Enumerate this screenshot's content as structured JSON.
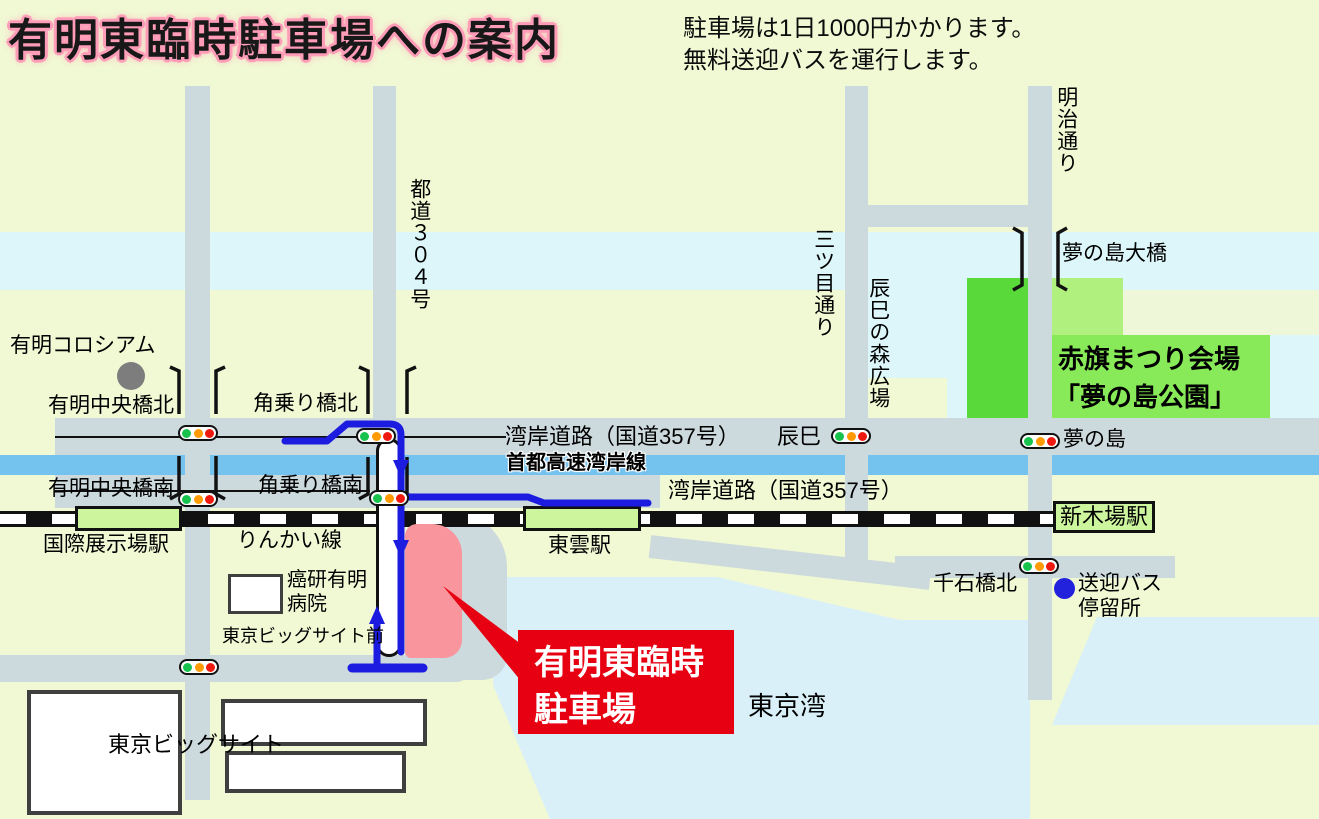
{
  "title": "有明東臨時駐車場への案内",
  "notes": [
    "駐車場は1日1000円かかります。",
    "無料送迎バスを運行します。"
  ],
  "colors": {
    "background": "#f1f8d4",
    "road": "#ccd9dd",
    "canal": "#dcf6fa",
    "bay_water": "#d9f0f8",
    "expressway_blue": "#74c2ee",
    "route_blue": "#1c1ce0",
    "parking_pink": "#f8959d",
    "accent_red": "#e60012",
    "park_green_dark": "#5ada3a",
    "park_green_mid": "#88ea58",
    "park_green_light": "#b0f07e",
    "station_green": "#ccf59e"
  },
  "icons": {
    "traffic_light": "traffic-light",
    "bus_stop_dot": "bus-stop-dot",
    "landmark_dot": "landmark-dot"
  },
  "map": {
    "labels": {
      "ariake_colosseum": "有明コロシアム",
      "ariake_chuo_kita": "有明中央橋北",
      "ariake_chuo_minami": "有明中央橋南",
      "kakunori_kita": "角乗り橋北",
      "kakunori_minami": "角乗り橋南",
      "todo304": "都道３０４号",
      "wangan_route_upper": "湾岸道路（国道357号）",
      "tatsumi": "辰巳",
      "shuto_expressway": "首都高速湾岸線",
      "wangan_route_lower": "湾岸道路（国道357号）",
      "rinkai_line": "りんかい線",
      "kokusai_tenjijo_sta": "国際展示場駅",
      "shinonome_sta": "東雲駅",
      "shinkiba_sta": "新木場駅",
      "ganken_hospital": "癌研有明\n病院",
      "bigsight_mae": "東京ビッグサイト前",
      "tokyo_bigsight": "東京ビッグサイト",
      "mitsume_dori": "三ツ目通り",
      "tatsumi_no_mori": "辰巳の森広場",
      "meiji_dori": "明治通り",
      "yumenoshima_ohashi": "夢の島大橋",
      "akahata_line1": "赤旗まつり会場",
      "akahata_line2": "「夢の島公園」",
      "yumenoshima": "夢の島",
      "senseki_bashi_kita": "千石橋北",
      "sogei_bus_stop": "送迎バス\n停留所",
      "tokyo_bay": "東京湾",
      "parking_box": "有明東臨時\n駐車場"
    }
  }
}
